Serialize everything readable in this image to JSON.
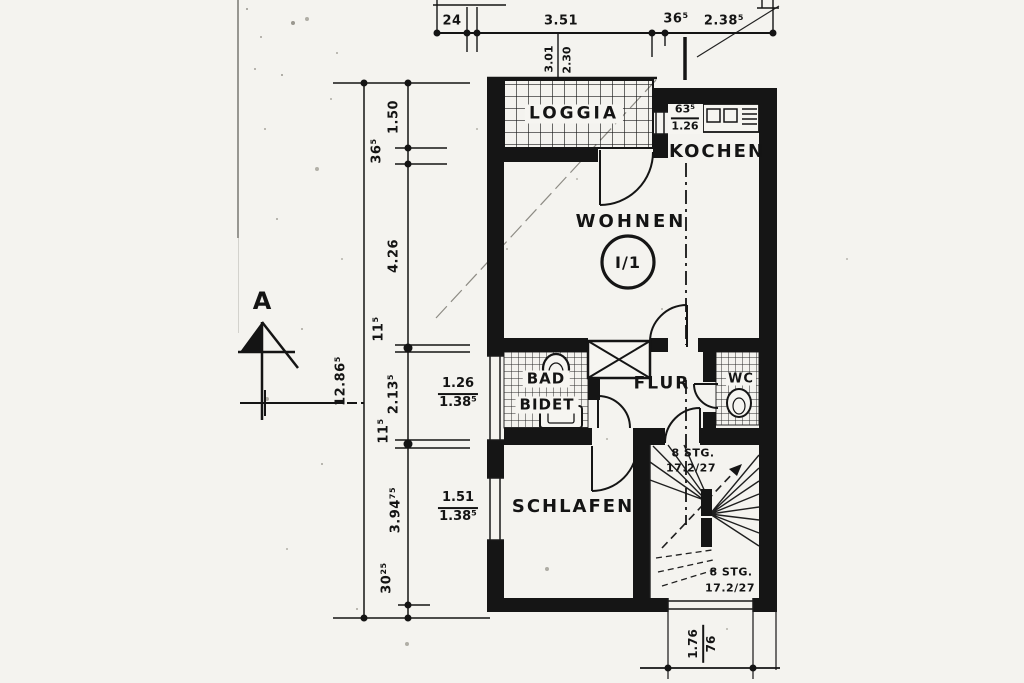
{
  "paper": {
    "section_label": "A"
  },
  "rooms": {
    "loggia": "LOGGIA",
    "kochen": "KOCHEN",
    "wohnen": "WOHNEN",
    "bad": "BAD",
    "bidet": "BIDET",
    "flur": "FLUR",
    "wc": "WC",
    "schlafen": "SCHLAFEN"
  },
  "unit": {
    "label": "I/1"
  },
  "dims": {
    "top": {
      "d1": "24",
      "d2": "3.51",
      "d3": "36⁵",
      "d4": "2.38⁵"
    },
    "loggia_depth": {
      "a": "3.01",
      "b": "2.30"
    },
    "chain": {
      "segments": [
        "1.50",
        "36⁵",
        "4.26",
        "11⁵",
        "2.13⁵",
        "11⁵",
        "3.94⁷⁵",
        "30²⁵"
      ],
      "total": "12.86⁵"
    },
    "kochen_niche": {
      "top": "63⁵",
      "bottom": "1.26"
    },
    "window_bad": {
      "top": "1.26",
      "bottom": "1.38⁵"
    },
    "window_schlafen": {
      "top": "1.51",
      "bottom": "1.38⁵"
    },
    "stair_exit": {
      "top": "1.76",
      "bottom": "76"
    }
  },
  "stairs": {
    "upper": {
      "line1": "8 STG.",
      "line2": "17.2/27"
    },
    "lower": {
      "line1": "8 STG.",
      "line2": "17.2/27"
    }
  }
}
